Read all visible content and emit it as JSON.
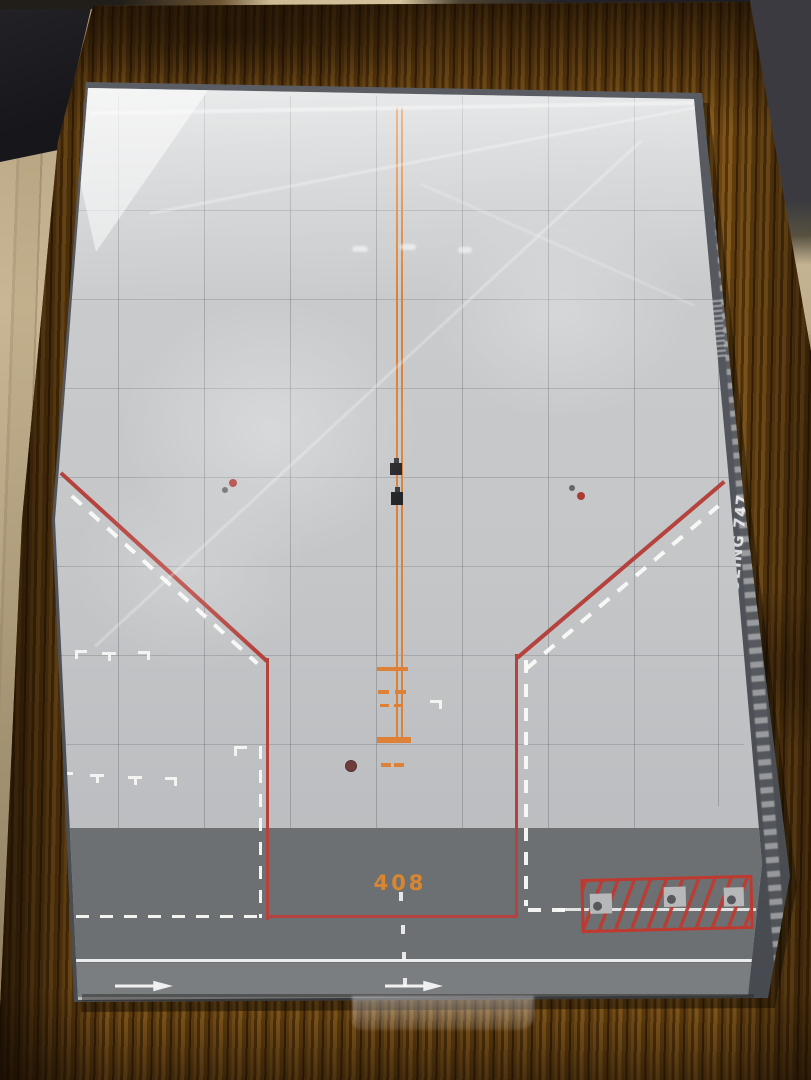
{
  "photo": {
    "description": "Shrink-wrapped model airport apron display base on a wooden table",
    "mat": {
      "stand_number": "408",
      "surface_color": "#c5c7c9",
      "taxiway_band_color": "#6d7073",
      "centerline_color": "#de8136",
      "boundary_red_color": "#b5423c",
      "marking_white_color": "#f3f3f1"
    },
    "box_spine": {
      "brand": "ANA",
      "model": "BOEING 747",
      "text_color": "#e7e8ea",
      "spine_color": "#54575c"
    },
    "environment": {
      "table_wood_color": "#6f4814",
      "floor_color": "#c9b694"
    }
  }
}
